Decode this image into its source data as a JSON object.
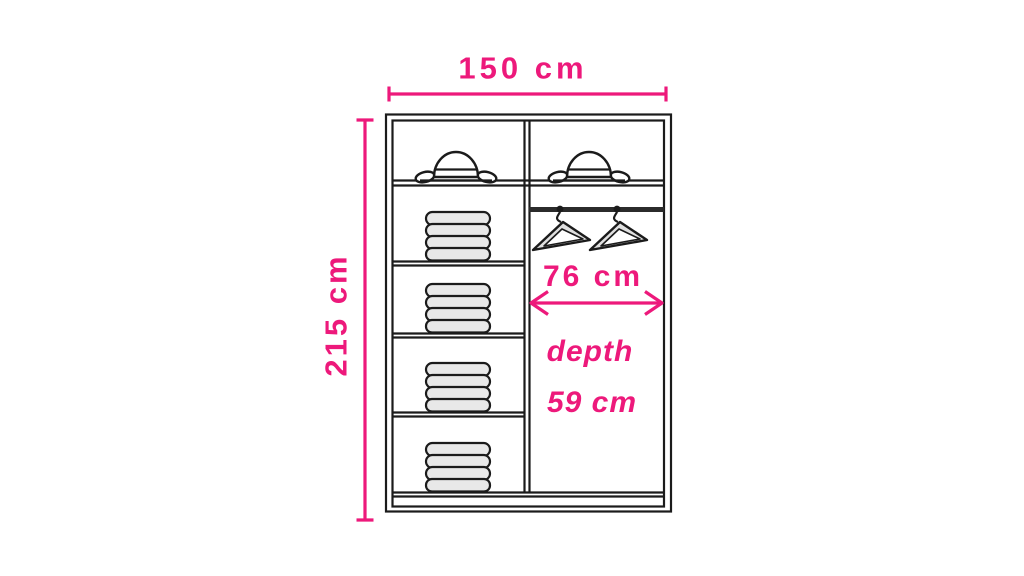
{
  "diagram": {
    "labels": {
      "width": "150 cm",
      "height": "215 cm",
      "hanging_width": "76 cm",
      "depth_line1": "depth",
      "depth_line2": "59 cm"
    },
    "colors": {
      "dimension_pink": "#ed197b",
      "outline_ink": "#1b1b1b",
      "clothes_fill": "#e8e8e8",
      "background": "#ffffff"
    },
    "contents": {
      "top_compartments": 2,
      "hats": 2,
      "left_shelves": 4,
      "clothes_stacks": 4,
      "hanging_rail": 1,
      "hangers": 2
    }
  }
}
